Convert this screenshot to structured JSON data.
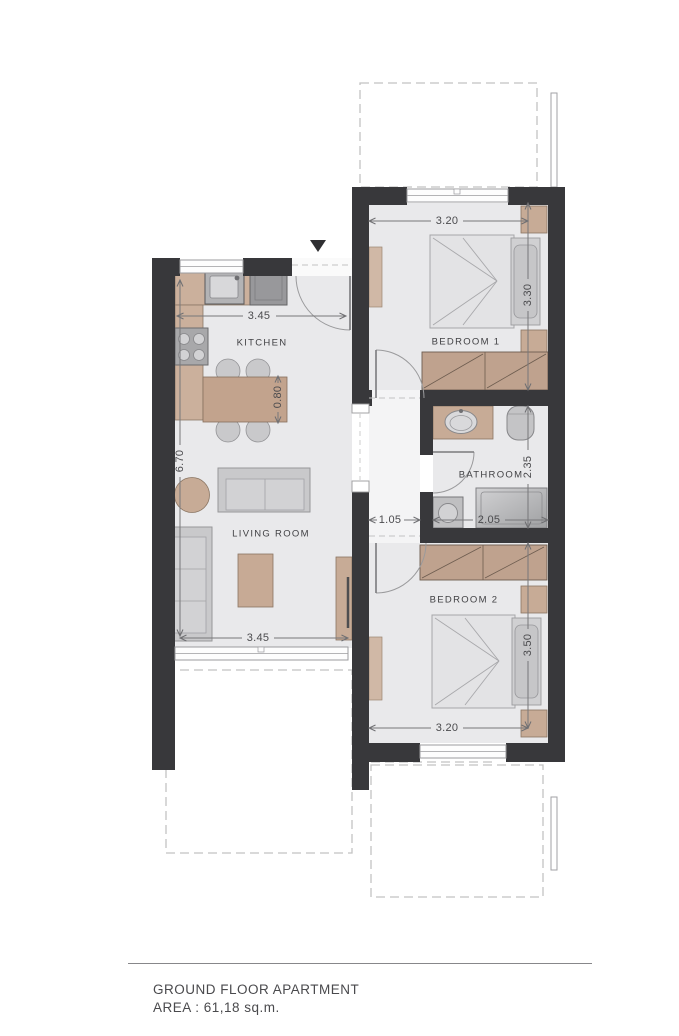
{
  "document": {
    "type": "architectural floor plan",
    "footer": {
      "title": "GROUND FLOOR APARTMENT",
      "area_label": "AREA : 61,18 sq.m."
    }
  },
  "rooms": {
    "kitchen": {
      "label": "KITCHEN"
    },
    "living": {
      "label": "LIVING ROOM"
    },
    "bathroom": {
      "label": "BATHROOM"
    },
    "bedroom1": {
      "label": "BEDROOM 1"
    },
    "bedroom2": {
      "label": "BEDROOM 2"
    }
  },
  "dims": {
    "kitchen_width": "3.45",
    "kitchen_living_length": "6.70",
    "island_depth": "0.80",
    "living_width": "3.45",
    "hall_width": "1.05",
    "bath_width": "2.05",
    "bath_depth": "2.35",
    "bedroom1_width": "3.20",
    "bedroom1_depth": "3.30",
    "bedroom2_width": "3.20",
    "bedroom2_depth": "3.50"
  },
  "colors": {
    "wall": "#38383b",
    "floor": "#e9e9eb",
    "hall_floor": "#f4f4f5",
    "wood": "#c7ab96",
    "wardrobe": "#bfa28e",
    "gray_furniture": "#c9c9cb",
    "dashed_outline": "#c2c2c2",
    "dimension": "#77777a"
  }
}
